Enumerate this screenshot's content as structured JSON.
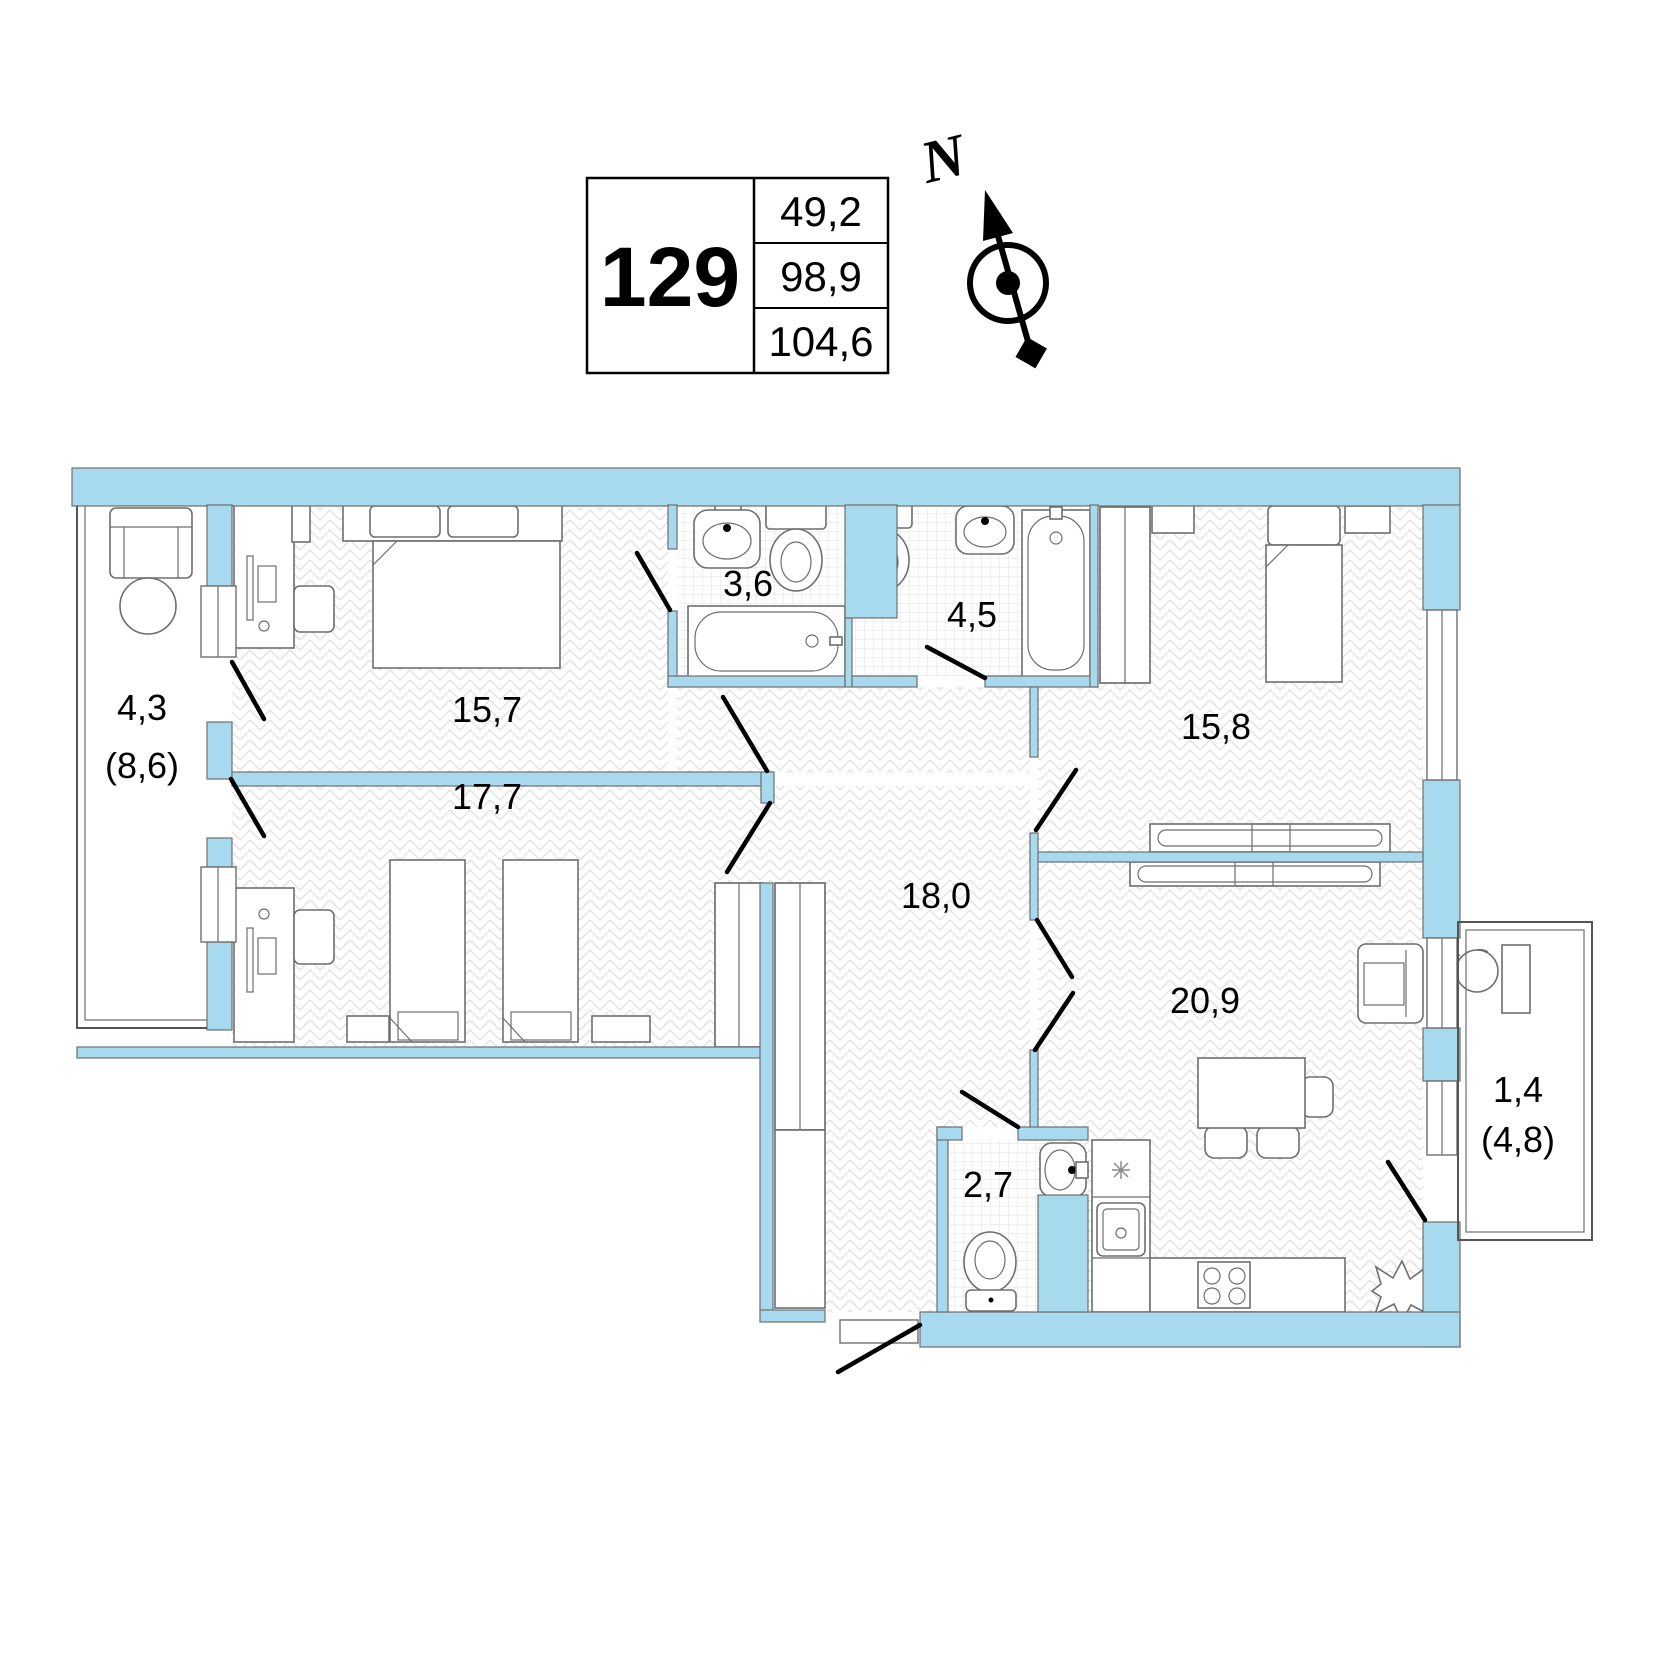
{
  "unit_info": {
    "number": "129",
    "values": [
      "49,2",
      "98,9",
      "104,6"
    ]
  },
  "compass": {
    "north_label": "N"
  },
  "rooms": {
    "balcony_left": {
      "area": "4,3",
      "area_total": "(8,6)"
    },
    "bedroom1": {
      "area": "15,7"
    },
    "bedroom2": {
      "area": "17,7"
    },
    "bathroom1": {
      "area": "3,6"
    },
    "bathroom2": {
      "area": "4,5"
    },
    "bedroom3": {
      "area": "15,8"
    },
    "hallway": {
      "area": "18,0"
    },
    "wc": {
      "area": "2,7"
    },
    "living_kitchen": {
      "area": "20,9"
    },
    "balcony_right": {
      "area": "1,4",
      "area_total": "(4,8)"
    }
  },
  "colors": {
    "wall_fill": "#a7daee",
    "wall_stroke": "#6e6e6e",
    "hatch": "#dcdcdc",
    "door": "#000000"
  }
}
